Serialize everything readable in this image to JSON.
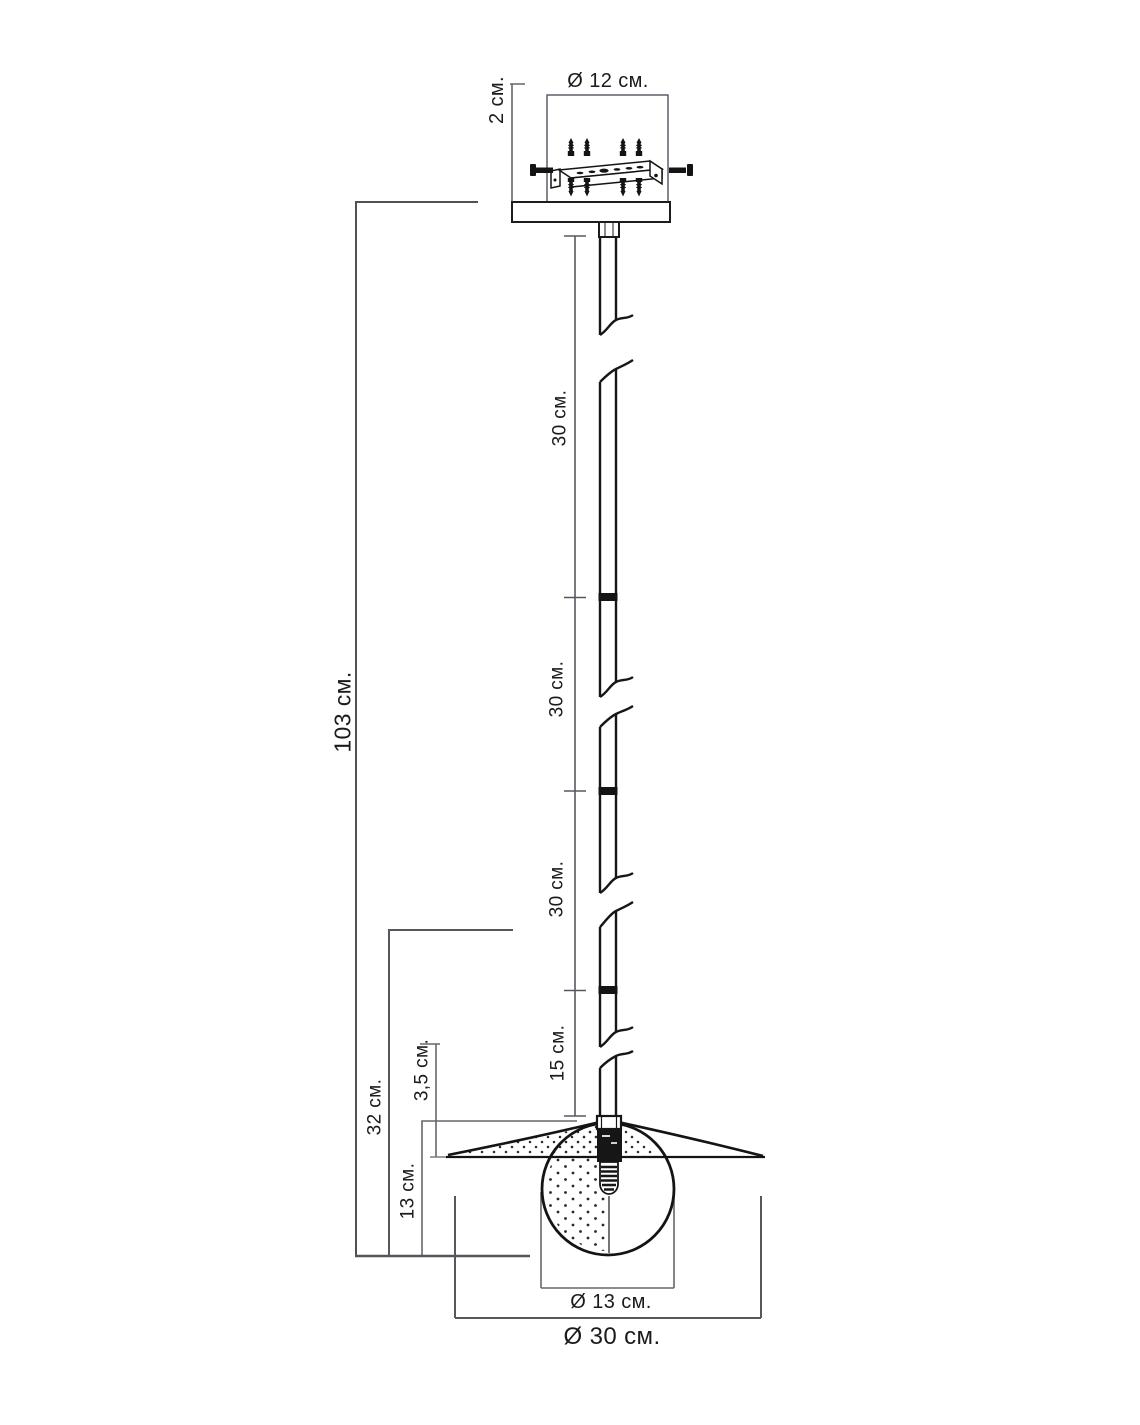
{
  "dimensions": {
    "canopy_diameter": "Ø 12 см.",
    "canopy_thickness": "2 см.",
    "rod_segment_1": "30 см.",
    "rod_segment_2": "30 см.",
    "rod_segment_3": "30 см.",
    "rod_segment_4": "15 см.",
    "total_height": "103 см.",
    "bottom_section_height": "32 см.",
    "shade_height": "3,5 см.",
    "bulb_section_height": "13 см.",
    "bulb_diameter": "Ø 13 см.",
    "shade_diameter": "Ø 30 см."
  },
  "colors": {
    "background": "#ffffff",
    "drawing_line": "#161618",
    "dimension_line": "#63676c",
    "canopy_box_border": "#4e565e",
    "text": "#1b1b1d"
  }
}
